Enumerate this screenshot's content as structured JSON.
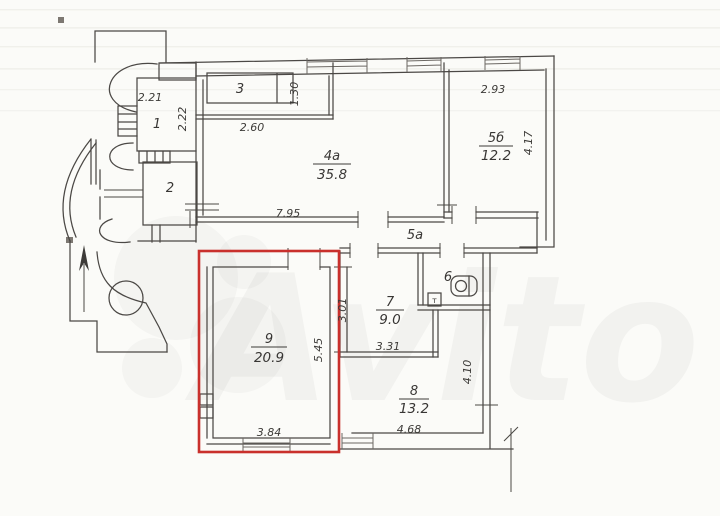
{
  "document": {
    "type": "apartment-floor-plan-scan",
    "highlight_note": "room 9 outlined in red"
  },
  "colors": {
    "highlight": "#c9302c",
    "line": "#4b4845",
    "background": "#fbfbf8"
  },
  "watermark": {
    "text": "Avito"
  },
  "rooms": {
    "r1": {
      "label": "1"
    },
    "r2": {
      "label": "2"
    },
    "r3": {
      "label": "3"
    },
    "r4a": {
      "label": "4a",
      "area": "35.8"
    },
    "r5a": {
      "label": "5a"
    },
    "r5b": {
      "label": "5б",
      "area": "12.2"
    },
    "r6": {
      "label": "6"
    },
    "r7": {
      "label": "7",
      "area": "9.0"
    },
    "r8": {
      "label": "8",
      "area": "13.2"
    },
    "r9": {
      "label": "9",
      "area": "20.9"
    }
  },
  "dimensions": {
    "r1_width": "2.21",
    "r1_depth": "2.22",
    "r3_width": "2.60",
    "r3_depth": "1.30",
    "r4a_width": "7.95",
    "r5b_width": "2.93",
    "r5b_depth": "4.17",
    "r7_depth": "3.01",
    "r7_width": "3.31",
    "r8_width": "4.68",
    "r8_depth": "4.10",
    "r9_width": "3.84",
    "r9_depth": "5.45"
  },
  "fixtures": {
    "tank_label": "т"
  }
}
